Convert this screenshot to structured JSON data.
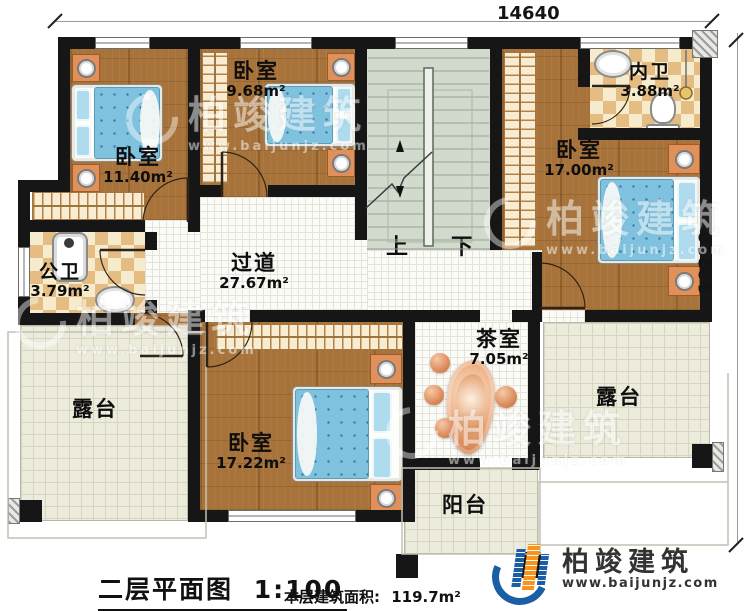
{
  "dimensions": {
    "width_top": "14640",
    "height_right": "10210"
  },
  "rooms": {
    "bedroom_top_left": {
      "label": "卧室",
      "area": "11.40m²"
    },
    "bedroom_top_mid": {
      "label": "卧室",
      "area": "9.68m²"
    },
    "bedroom_right": {
      "label": "卧室",
      "area": "17.00m²"
    },
    "bedroom_bottom": {
      "label": "卧室",
      "area": "17.22m²"
    },
    "public_bathroom": {
      "label": "公卫",
      "area": "3.79m²"
    },
    "ensuite_bathroom": {
      "label": "内卫",
      "area": "3.88m²"
    },
    "hallway": {
      "label": "过道",
      "area": "27.67m²"
    },
    "tea_room": {
      "label": "茶室",
      "area": "7.05m²"
    },
    "terrace_left": {
      "label": "露台"
    },
    "terrace_right": {
      "label": "露台"
    },
    "balcony": {
      "label": "阳台"
    }
  },
  "stairs": {
    "up_label": "上",
    "down_label": "下"
  },
  "footer": {
    "title": "二层平面图",
    "scale": "1:100",
    "area_label": "本层建筑面积:",
    "area_value": "119.7m²"
  },
  "brand": {
    "name": "柏竣建筑",
    "url": "www.baijunjz.com"
  },
  "watermark": {
    "name": "柏竣建筑",
    "url": "www.baijunjz.com"
  },
  "colors": {
    "wall": "#161616",
    "wood_floor": "#a8733a",
    "bed": "#7fc2df",
    "bath_tile": "#e5bd82",
    "terrace": "#edebdb",
    "brand_blue": "#1b5ea6",
    "brand_orange": "#f7941d"
  }
}
